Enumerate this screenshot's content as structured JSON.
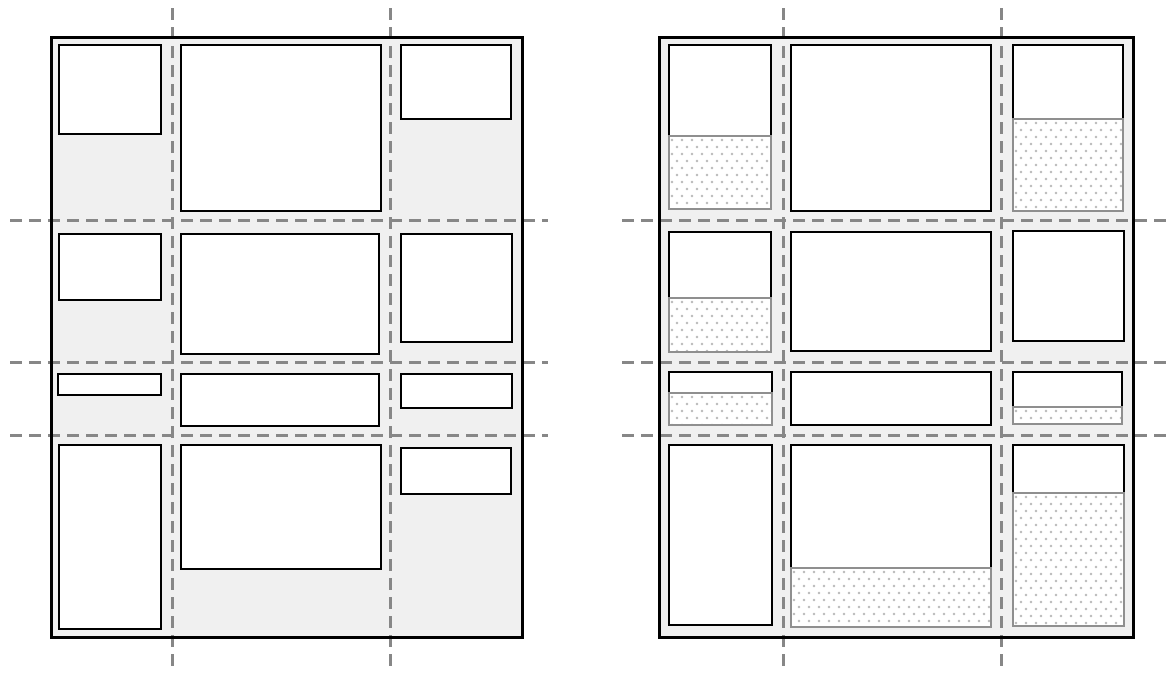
{
  "canvas": {
    "width": 1171,
    "height": 679,
    "background": "#ffffff"
  },
  "colors": {
    "container_fill": "#f0f0f0",
    "container_border": "#000000",
    "item_fill": "#ffffff",
    "item_border": "#000000",
    "gridline": "#878787",
    "reserved_fill": "#ffffff",
    "reserved_border": "#8f8f8f",
    "reserved_dot": "#bfbfbf"
  },
  "gridline_style": {
    "dash": 12,
    "gap": 7,
    "thickness": 2.5
  },
  "container_border_width": 3,
  "item_border_width": 2.5,
  "reserved_border_width": 2,
  "panels": [
    {
      "name": "grid-diagram-left",
      "container": {
        "x": 50,
        "y": 36,
        "w": 474,
        "h": 603
      },
      "vlines": [
        {
          "x": 171,
          "y1": 8,
          "y2": 670
        },
        {
          "x": 389,
          "y1": 8,
          "y2": 670
        }
      ],
      "hlines": [
        {
          "y": 219,
          "x1": 10,
          "x2": 548
        },
        {
          "y": 361,
          "x1": 10,
          "x2": 548
        },
        {
          "y": 434,
          "x1": 10,
          "x2": 548
        }
      ],
      "items": [
        {
          "row": 1,
          "col": 1,
          "x": 58,
          "y": 44,
          "w": 104,
          "h": 91,
          "res_h": 0
        },
        {
          "row": 1,
          "col": 2,
          "x": 180,
          "y": 44,
          "w": 202,
          "h": 168,
          "res_h": 0
        },
        {
          "row": 1,
          "col": 3,
          "x": 400,
          "y": 44,
          "w": 112,
          "h": 76,
          "res_h": 0
        },
        {
          "row": 2,
          "col": 1,
          "x": 58,
          "y": 233,
          "w": 104,
          "h": 68,
          "res_h": 0
        },
        {
          "row": 2,
          "col": 2,
          "x": 180,
          "y": 233,
          "w": 200,
          "h": 122,
          "res_h": 0
        },
        {
          "row": 2,
          "col": 3,
          "x": 400,
          "y": 233,
          "w": 113,
          "h": 110,
          "res_h": 0
        },
        {
          "row": 3,
          "col": 1,
          "x": 57,
          "y": 373,
          "w": 105,
          "h": 23,
          "res_h": 0
        },
        {
          "row": 3,
          "col": 2,
          "x": 180,
          "y": 373,
          "w": 200,
          "h": 54,
          "res_h": 0
        },
        {
          "row": 3,
          "col": 3,
          "x": 400,
          "y": 373,
          "w": 113,
          "h": 36,
          "res_h": 0
        },
        {
          "row": 4,
          "col": 1,
          "x": 58,
          "y": 444,
          "w": 104,
          "h": 186,
          "res_h": 0
        },
        {
          "row": 4,
          "col": 2,
          "x": 180,
          "y": 444,
          "w": 202,
          "h": 126,
          "res_h": 0
        },
        {
          "row": 4,
          "col": 3,
          "x": 400,
          "y": 447,
          "w": 112,
          "h": 48,
          "res_h": 0
        }
      ]
    },
    {
      "name": "grid-diagram-right",
      "container": {
        "x": 658,
        "y": 36,
        "w": 477,
        "h": 603
      },
      "vlines": [
        {
          "x": 782,
          "y1": 8,
          "y2": 670
        },
        {
          "x": 1000,
          "y1": 8,
          "y2": 670
        }
      ],
      "hlines": [
        {
          "y": 219,
          "x1": 622,
          "x2": 1168
        },
        {
          "y": 361,
          "x1": 622,
          "x2": 1168
        },
        {
          "y": 434,
          "x1": 622,
          "x2": 1168
        }
      ],
      "items": [
        {
          "row": 1,
          "col": 1,
          "x": 668,
          "y": 44,
          "w": 104,
          "h": 91,
          "res_h": 75
        },
        {
          "row": 1,
          "col": 2,
          "x": 790,
          "y": 44,
          "w": 202,
          "h": 168,
          "res_h": 0
        },
        {
          "row": 1,
          "col": 3,
          "x": 1012,
          "y": 44,
          "w": 112,
          "h": 74,
          "res_h": 94
        },
        {
          "row": 2,
          "col": 1,
          "x": 668,
          "y": 231,
          "w": 104,
          "h": 66,
          "res_h": 56
        },
        {
          "row": 2,
          "col": 2,
          "x": 790,
          "y": 231,
          "w": 202,
          "h": 121,
          "res_h": 0
        },
        {
          "row": 2,
          "col": 3,
          "x": 1012,
          "y": 230,
          "w": 113,
          "h": 112,
          "res_h": 0
        },
        {
          "row": 3,
          "col": 1,
          "x": 668,
          "y": 371,
          "w": 105,
          "h": 21,
          "res_h": 34
        },
        {
          "row": 3,
          "col": 2,
          "x": 790,
          "y": 371,
          "w": 202,
          "h": 55,
          "res_h": 0
        },
        {
          "row": 3,
          "col": 3,
          "x": 1012,
          "y": 371,
          "w": 111,
          "h": 35,
          "res_h": 19
        },
        {
          "row": 4,
          "col": 1,
          "x": 668,
          "y": 444,
          "w": 105,
          "h": 182,
          "res_h": 0
        },
        {
          "row": 4,
          "col": 2,
          "x": 790,
          "y": 444,
          "w": 202,
          "h": 123,
          "res_h": 61
        },
        {
          "row": 4,
          "col": 3,
          "x": 1012,
          "y": 444,
          "w": 113,
          "h": 48,
          "res_h": 135
        }
      ]
    }
  ]
}
